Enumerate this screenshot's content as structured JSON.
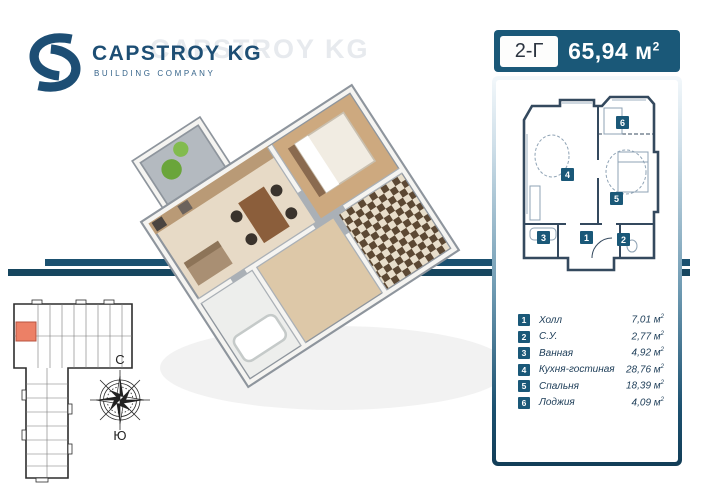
{
  "brand": {
    "name": "CAPSTROY KG",
    "tagline": "BUILDING COMPANY",
    "watermark": "CAPSTROY KG",
    "logo_color": "#1d4e74"
  },
  "header": {
    "unit_label": "2-Г",
    "area_value": "65,94",
    "bg_color": "#1a5878"
  },
  "units": {
    "base": "м",
    "sup": "2"
  },
  "legend": {
    "rows": [
      {
        "num": "1",
        "name": "Холл",
        "area": "7,01"
      },
      {
        "num": "2",
        "name": "С.У.",
        "area": "2,77"
      },
      {
        "num": "3",
        "name": "Ванная",
        "area": "4,92"
      },
      {
        "num": "4",
        "name": "Кухня-гостиная",
        "area": "28,76"
      },
      {
        "num": "5",
        "name": "Спальня",
        "area": "18,39"
      },
      {
        "num": "6",
        "name": "Лоджия",
        "area": "4,09"
      }
    ]
  },
  "compass": {
    "north": "С",
    "south": "Ю"
  },
  "colors": {
    "accent_dark": "#16465f",
    "accent": "#1a5878",
    "highlight_unit": "#ec8066",
    "plan_wall": "#34495e",
    "wood_floor": "#cda97f",
    "beige_floor": "#e7dac6"
  }
}
